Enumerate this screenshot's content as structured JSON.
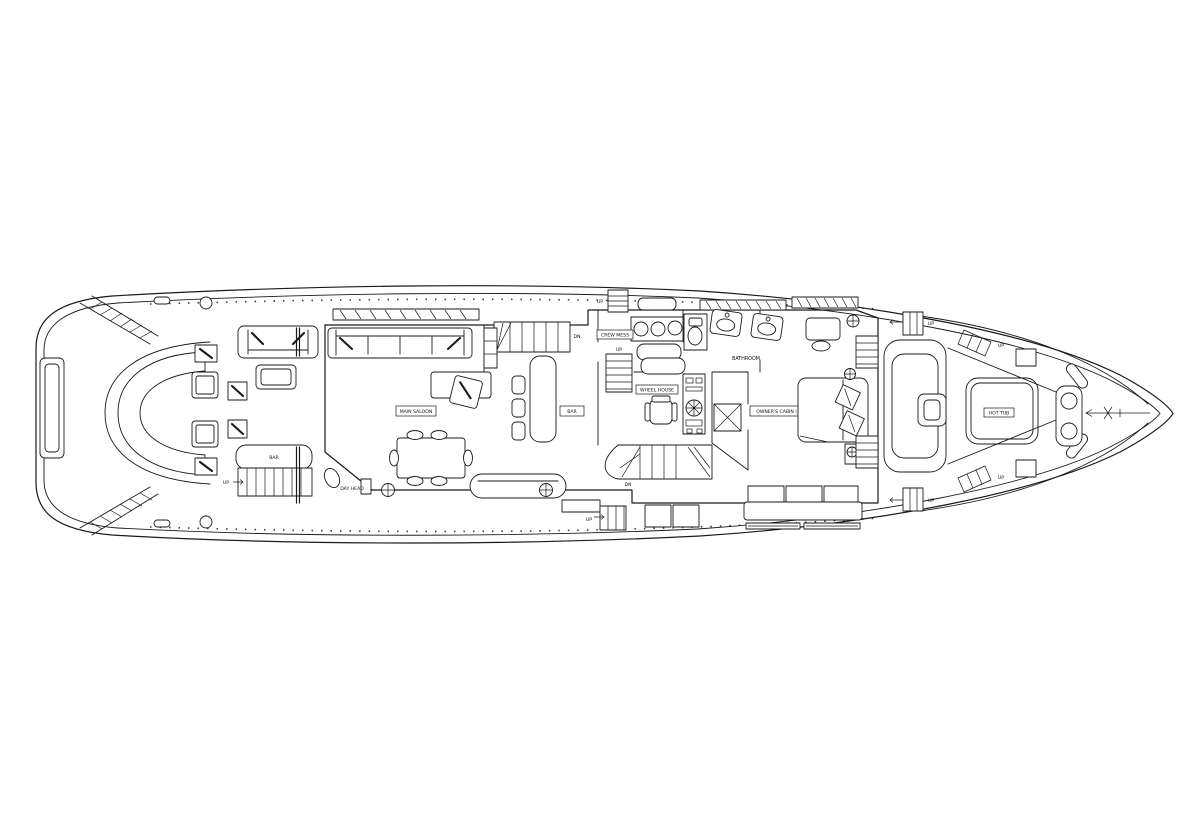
{
  "drawing": {
    "type": "yacht main deck floor plan - black line art on white",
    "colors": {
      "background": "#ffffff",
      "line": "#1a1a1a"
    },
    "labels": {
      "main_saloon": "MAIN SALOON",
      "bar_aft": "BAR",
      "bar_mid": "BAR",
      "day_head": "DAY HEAD",
      "crew_mess": "CREW MESS",
      "wheel_house": "WHEEL HOUSE",
      "bathroom": "BATHROOM",
      "owners_cabin": "OWNER'S CABIN (1)",
      "hot_tub": "HOT TUB"
    },
    "stair_labels": {
      "up": "UP",
      "dn": "DN"
    }
  }
}
